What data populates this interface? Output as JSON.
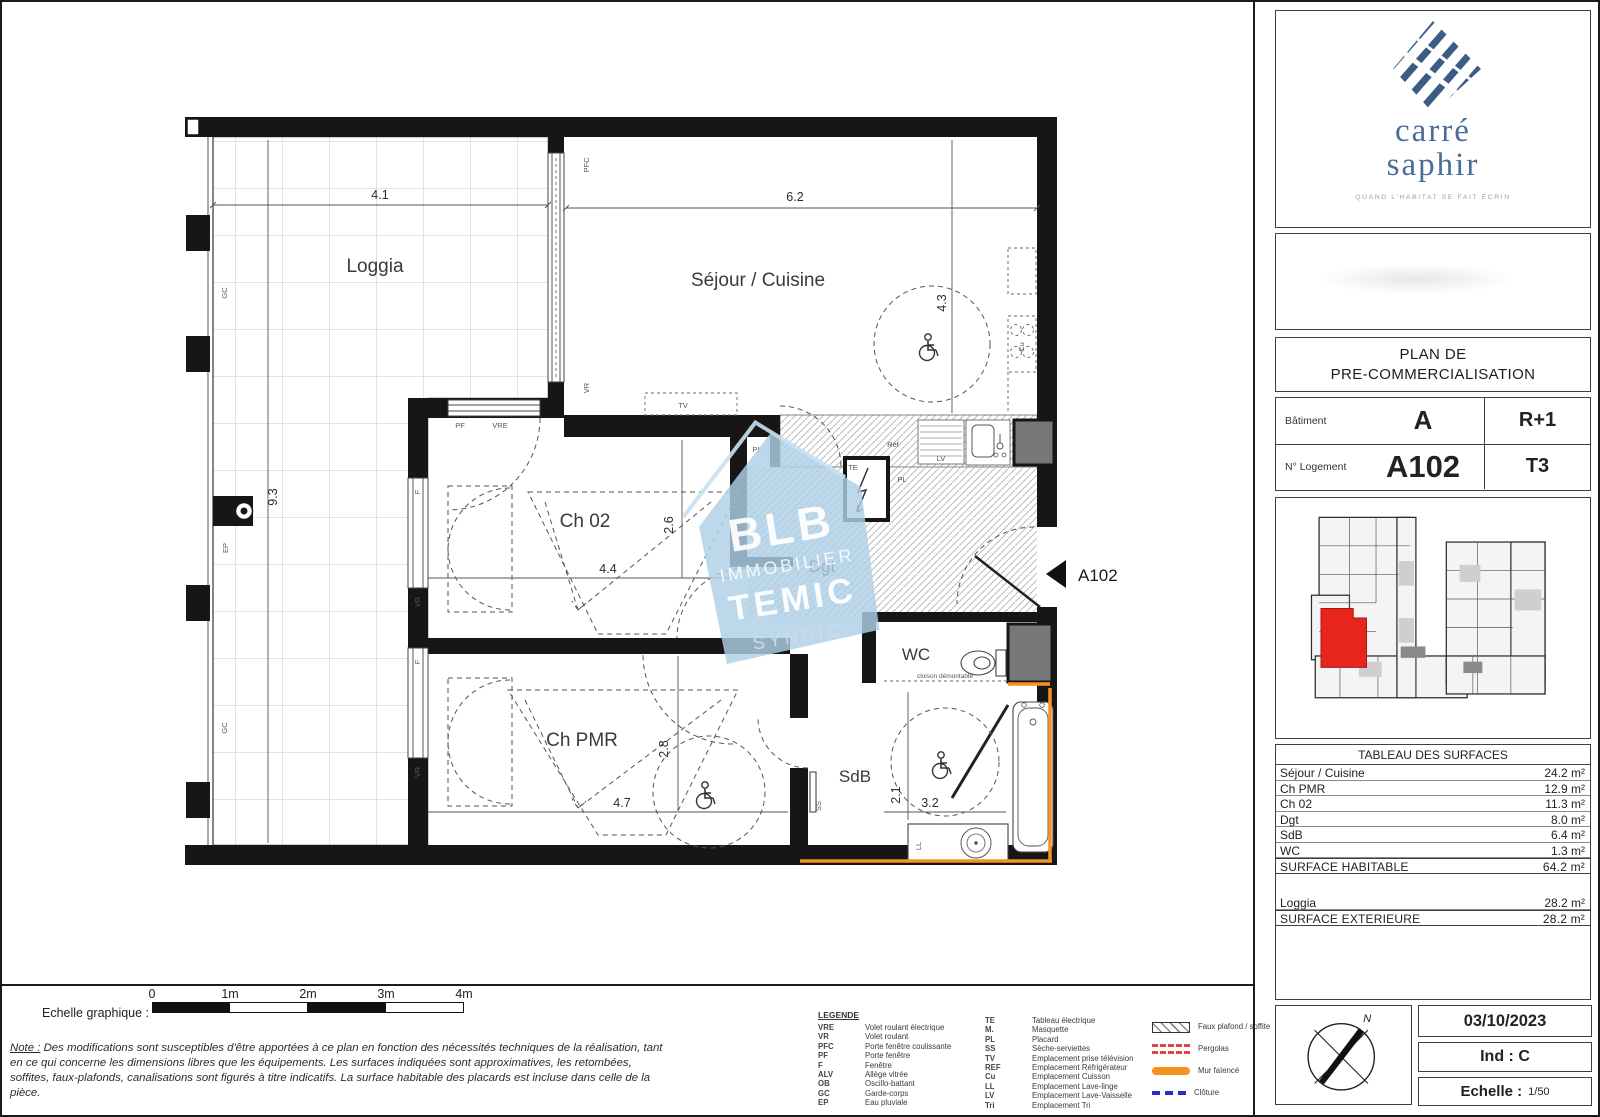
{
  "branding": {
    "line1": "carré",
    "line2": "saphir",
    "tagline": "QUAND L'HABITAT SE FAIT ÉCRIN",
    "logo_color": "#3d5c85"
  },
  "title_block": {
    "line1": "PLAN DE",
    "line2": "PRE-COMMERCIALISATION"
  },
  "info": {
    "batiment_label": "Bâtiment",
    "batiment": "A",
    "niveau": "R+1",
    "logement_label": "N° Logement",
    "logement": "A102",
    "type": "T3"
  },
  "surfaces": {
    "title": "TABLEAU DES SURFACES",
    "rows": [
      {
        "label": "Séjour / Cuisine",
        "value": "24.2 m²"
      },
      {
        "label": "Ch PMR",
        "value": "12.9 m²"
      },
      {
        "label": "Ch 02",
        "value": "11.3 m²"
      },
      {
        "label": "Dgt",
        "value": "8.0 m²"
      },
      {
        "label": "SdB",
        "value": "6.4 m²"
      },
      {
        "label": "WC",
        "value": "1.3 m²"
      }
    ],
    "habitable": {
      "label": "SURFACE HABITABLE",
      "value": "64.2 m²"
    },
    "loggia": {
      "label": "Loggia",
      "value": "28.2 m²"
    },
    "exterieure": {
      "label": "SURFACE EXTERIEURE",
      "value": "28.2 m²"
    }
  },
  "footer": {
    "date": "03/10/2023",
    "ind": "Ind : C",
    "echelle_label": "Echelle :",
    "echelle_value": "1/50",
    "north": "N"
  },
  "scalebar": {
    "label": "Echelle graphique :",
    "t0": "0",
    "t1": "1m",
    "t2": "2m",
    "t3": "3m",
    "t4": "4m"
  },
  "note": {
    "label": "Note :",
    "text": "Des modifications sont susceptibles d'être apportées à ce plan en fonction des nécessités techniques de la réalisation, tant en ce qui concerne les dimensions libres que les équipements. Les surfaces indiquées sont approximatives, les retombées, soffites, faux-plafonds, canalisations sont figurés à titre indicatifs. La surface habitable des placards est incluse dans celle de la pièce."
  },
  "legend": {
    "title": "LEGENDE",
    "col1": [
      {
        "abbr": "VRE",
        "label": "Volet roulant électrique"
      },
      {
        "abbr": "VR",
        "label": "Volet roulant"
      },
      {
        "abbr": "PFC",
        "label": "Porte fenêtre coulissante"
      },
      {
        "abbr": "PF",
        "label": "Porte fenêtre"
      },
      {
        "abbr": "F",
        "label": "Fenêtre"
      },
      {
        "abbr": "ALV",
        "label": "Allège vitrée"
      },
      {
        "abbr": "OB",
        "label": "Oscillo-battant"
      },
      {
        "abbr": "GC",
        "label": "Garde-corps"
      },
      {
        "abbr": "EP",
        "label": "Eau pluviale"
      }
    ],
    "col2": [
      {
        "abbr": "TE",
        "label": "Tableau électrique"
      },
      {
        "abbr": "M.",
        "label": "Masquette"
      },
      {
        "abbr": "PL",
        "label": "Placard"
      },
      {
        "abbr": "SS",
        "label": "Sèche-serviettes"
      },
      {
        "abbr": "TV",
        "label": "Emplacement prise télévision"
      },
      {
        "abbr": "REF",
        "label": "Emplacement Réfrigérateur"
      },
      {
        "abbr": "Cu",
        "label": "Emplacement Cuisson"
      },
      {
        "abbr": "LL",
        "label": "Emplacement Lave-linge"
      },
      {
        "abbr": "LV",
        "label": "Emplacement Lave-Vaisselle"
      },
      {
        "abbr": "Tri",
        "label": "Emplacement Tri"
      }
    ],
    "symbols": [
      {
        "key": "faux-plafond",
        "label": "Faux plafond / soffite"
      },
      {
        "key": "pergolas",
        "label": "Pergolas"
      },
      {
        "key": "mur-faience",
        "label": "Mur faïencé"
      },
      {
        "key": "cloture",
        "label": "Clôture"
      }
    ]
  },
  "plan": {
    "rooms": {
      "loggia": "Loggia",
      "sejour": "Séjour / Cuisine",
      "ch02": "Ch 02",
      "dgt": "Dgt",
      "wc": "WC",
      "chpmr": "Ch PMR",
      "sdb": "SdB"
    },
    "dims": {
      "loggia_w": "4.1",
      "sejour_w": "6.2",
      "left_h": "9.3",
      "sejour_h": "4.3",
      "ch02_h": "2.6",
      "ch02_w": "4.4",
      "chpmr_h": "2.8",
      "chpmr_w": "4.7",
      "sdb_h": "2.1",
      "sdb_w": "3.2"
    },
    "labels": {
      "gc": "GC",
      "ep": "EP",
      "pfc": "PFC",
      "vr": "VR",
      "vre": "VRE",
      "pf": "PF",
      "f": "F",
      "tv": "TV",
      "pl": "PL",
      "te": "TE",
      "ref": "Réf",
      "lv": "LV",
      "cu": "Cu",
      "ss": "SS",
      "ll": "LL",
      "cloison": "cloison démontable"
    },
    "entrance": "A102"
  },
  "watermark": {
    "line1": "BLB",
    "line2": "IMMOBILIER",
    "line3": "TEMIC",
    "line4": "SYNDIC"
  },
  "colors": {
    "accent_orange": "#f5931e",
    "keyplan_red": "#e8251d",
    "watermark_blue": "#aed0e6",
    "logo_navy": "#3d5c85"
  }
}
